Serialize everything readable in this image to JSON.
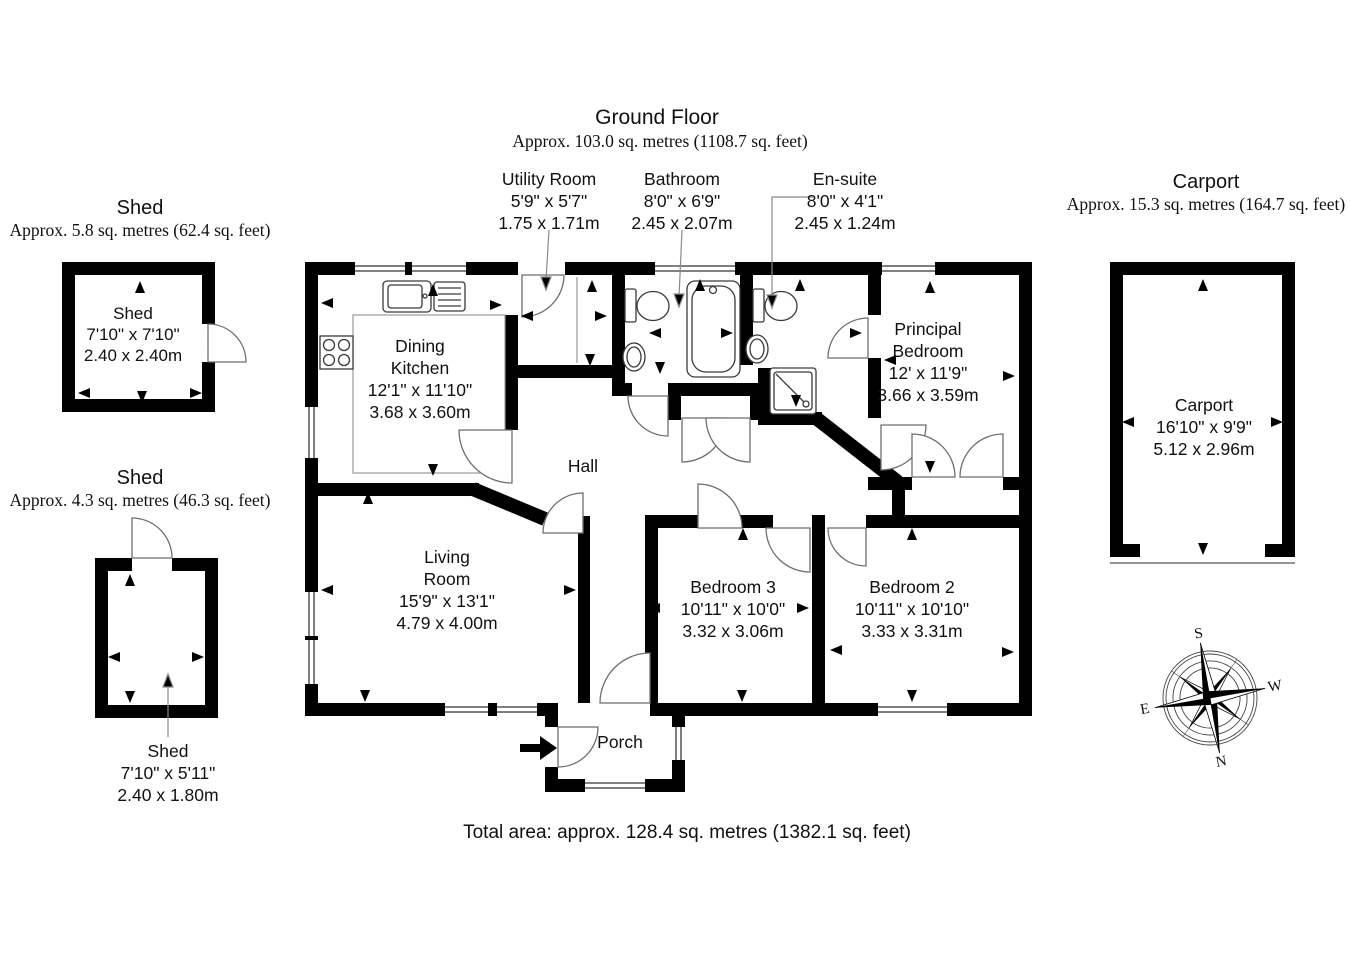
{
  "ground_floor": {
    "title": "Ground Floor",
    "area": "Approx. 103.0 sq. metres (1108.7 sq. feet)",
    "rooms": {
      "utility": {
        "name": "Utility Room",
        "imperial": "5'9\" x 5'7\"",
        "metric": "1.75 x 1.71m"
      },
      "bathroom": {
        "name": "Bathroom",
        "imperial": "8'0\" x 6'9\"",
        "metric": "2.45 x 2.07m"
      },
      "ensuite": {
        "name": "En-suite",
        "imperial": "8'0\" x 4'1\"",
        "metric": "2.45 x 1.24m"
      },
      "dining_kitchen": {
        "line1": "Dining",
        "line2": "Kitchen",
        "imperial": "12'1\" x 11'10\"",
        "metric": "3.68 x 3.60m"
      },
      "principal": {
        "line1": "Principal",
        "line2": "Bedroom",
        "imperial": "12' x 11'9\"",
        "metric": "3.66 x 3.59m"
      },
      "hall": {
        "name": "Hall"
      },
      "living": {
        "line1": "Living",
        "line2": "Room",
        "imperial": "15'9\" x 13'1\"",
        "metric": "4.79 x 4.00m"
      },
      "bedroom3": {
        "name": "Bedroom 3",
        "imperial": "10'11\" x 10'0\"",
        "metric": "3.32 x 3.06m"
      },
      "bedroom2": {
        "name": "Bedroom 2",
        "imperial": "10'11\" x 10'10\"",
        "metric": "3.33 x 3.31m"
      },
      "porch": {
        "name": "Porch"
      }
    }
  },
  "shed1": {
    "title": "Shed",
    "area": "Approx. 5.8 sq. metres (62.4 sq. feet)",
    "label": {
      "name": "Shed",
      "imperial": "7'10\" x 7'10\"",
      "metric": "2.40 x 2.40m"
    }
  },
  "shed2": {
    "title": "Shed",
    "area": "Approx. 4.3 sq. metres (46.3 sq. feet)",
    "label": {
      "name": "Shed",
      "imperial": "7'10\" x 5'11\"",
      "metric": "2.40 x 1.80m"
    }
  },
  "carport": {
    "title": "Carport",
    "area": "Approx. 15.3 sq. metres (164.7 sq. feet)",
    "label": {
      "name": "Carport",
      "imperial": "16'10\" x 9'9\"",
      "metric": "5.12 x 2.96m"
    }
  },
  "total_area": "Total area: approx. 128.4 sq. metres (1382.1 sq. feet)",
  "compass": {
    "n": "N",
    "s": "S",
    "e": "E",
    "w": "W"
  },
  "colors": {
    "wall": "#000000",
    "door": "#6e6e6e",
    "fixture": "#3a3a3a",
    "background": "#ffffff"
  }
}
